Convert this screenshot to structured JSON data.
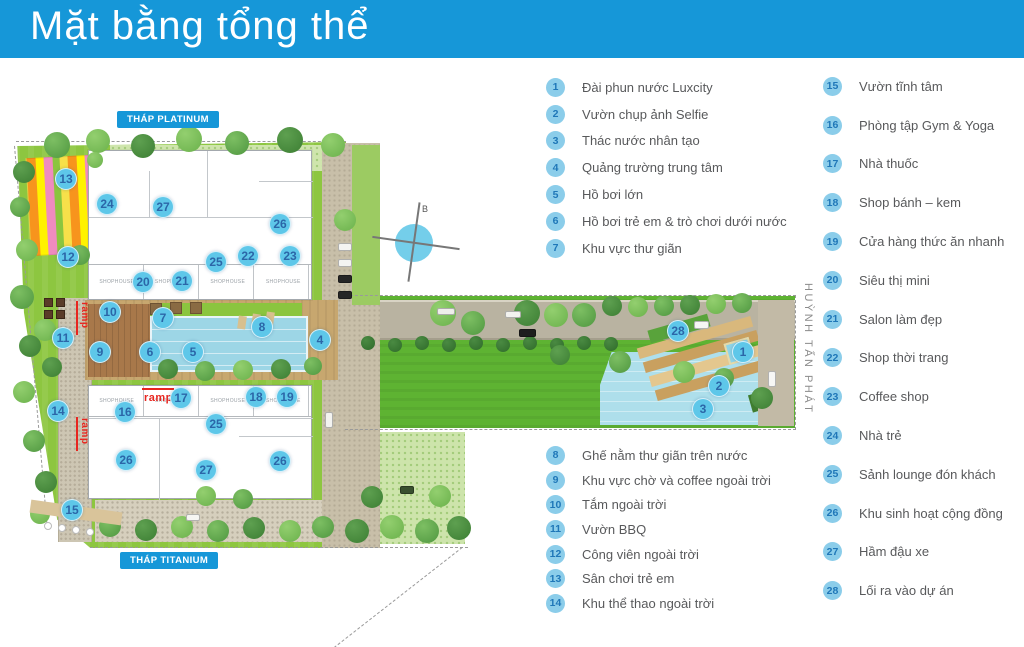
{
  "header": {
    "title": "Mặt bằng tổng thể",
    "bg_color": "#1697d8"
  },
  "map": {
    "tower_labels": [
      {
        "id": "platinum",
        "text": "THÁP PLATINUM"
      },
      {
        "id": "titanium",
        "text": "THÁP TITANIUM"
      }
    ],
    "street_label": "HUỲNH TẤN PHÁT",
    "compass_letter": "B",
    "ramp_label": "ramp",
    "room_label": "SHOPHOUSE",
    "marker_color": "#5ec7e9",
    "marker_number_color": "#2b66a8",
    "markers": [
      {
        "n": "1",
        "x": 743,
        "y": 352
      },
      {
        "n": "2",
        "x": 719,
        "y": 386
      },
      {
        "n": "3",
        "x": 703,
        "y": 409
      },
      {
        "n": "4",
        "x": 320,
        "y": 340
      },
      {
        "n": "5",
        "x": 193,
        "y": 352
      },
      {
        "n": "6",
        "x": 150,
        "y": 352
      },
      {
        "n": "7",
        "x": 163,
        "y": 318
      },
      {
        "n": "8",
        "x": 262,
        "y": 327
      },
      {
        "n": "9",
        "x": 100,
        "y": 352
      },
      {
        "n": "10",
        "x": 110,
        "y": 312
      },
      {
        "n": "11",
        "x": 63,
        "y": 338
      },
      {
        "n": "12",
        "x": 68,
        "y": 257
      },
      {
        "n": "13",
        "x": 66,
        "y": 179
      },
      {
        "n": "14",
        "x": 58,
        "y": 411
      },
      {
        "n": "15",
        "x": 72,
        "y": 510
      },
      {
        "n": "16",
        "x": 125,
        "y": 412
      },
      {
        "n": "17",
        "x": 181,
        "y": 398
      },
      {
        "n": "18",
        "x": 256,
        "y": 397
      },
      {
        "n": "19",
        "x": 287,
        "y": 397
      },
      {
        "n": "20",
        "x": 143,
        "y": 282
      },
      {
        "n": "21",
        "x": 182,
        "y": 281
      },
      {
        "n": "22",
        "x": 248,
        "y": 256
      },
      {
        "n": "23",
        "x": 290,
        "y": 256
      },
      {
        "n": "24",
        "x": 107,
        "y": 204
      },
      {
        "n": "25",
        "x": 216,
        "y": 262
      },
      {
        "n": "25",
        "x": 216,
        "y": 424
      },
      {
        "n": "26",
        "x": 280,
        "y": 224
      },
      {
        "n": "26",
        "x": 126,
        "y": 460
      },
      {
        "n": "26",
        "x": 280,
        "y": 461
      },
      {
        "n": "27",
        "x": 163,
        "y": 207
      },
      {
        "n": "27",
        "x": 206,
        "y": 470
      },
      {
        "n": "28",
        "x": 678,
        "y": 331
      }
    ]
  },
  "legend": {
    "circle_color": "#8bcdea",
    "number_color": "#1f77b8",
    "text_color": "#58595b",
    "columns": [
      {
        "position": "center-top",
        "items": [
          {
            "n": "1",
            "label": "Đài phun nước Luxcity"
          },
          {
            "n": "2",
            "label": "Vườn chụp ảnh Selfie"
          },
          {
            "n": "3",
            "label": "Thác nước nhân tạo"
          },
          {
            "n": "4",
            "label": "Quảng trường trung tâm"
          },
          {
            "n": "5",
            "label": "Hồ bơi lớn"
          },
          {
            "n": "6",
            "label": "Hồ bơi trẻ em & trò chơi dưới nước"
          },
          {
            "n": "7",
            "label": "Khu vực thư giãn"
          }
        ]
      },
      {
        "position": "center-bottom",
        "items": [
          {
            "n": "8",
            "label": "Ghế nằm thư giãn trên nước"
          },
          {
            "n": "9",
            "label": "Khu vực chờ và coffee ngoài trời"
          },
          {
            "n": "10",
            "label": "Tắm ngoài trời"
          },
          {
            "n": "11",
            "label": "Vườn BBQ"
          },
          {
            "n": "12",
            "label": "Công viên ngoài trời"
          },
          {
            "n": "13",
            "label": "Sân chơi trẻ em"
          },
          {
            "n": "14",
            "label": "Khu thể thao ngoài trời"
          }
        ]
      },
      {
        "position": "right",
        "items": [
          {
            "n": "15",
            "label": "Vườn tĩnh tâm"
          },
          {
            "n": "16",
            "label": "Phòng tập Gym & Yoga"
          },
          {
            "n": "17",
            "label": "Nhà thuốc"
          },
          {
            "n": "18",
            "label": "Shop bánh – kem"
          },
          {
            "n": "19",
            "label": "Cửa hàng thức ăn nhanh"
          },
          {
            "n": "20",
            "label": "Siêu thị mini"
          },
          {
            "n": "21",
            "label": "Salon làm đẹp"
          },
          {
            "n": "22",
            "label": "Shop thời trang"
          },
          {
            "n": "23",
            "label": "Coffee shop"
          },
          {
            "n": "24",
            "label": "Nhà trẻ"
          },
          {
            "n": "25",
            "label": "Sảnh lounge đón khách"
          },
          {
            "n": "26",
            "label": "Khu sinh hoạt cộng đồng"
          },
          {
            "n": "27",
            "label": "Hầm đậu xe"
          },
          {
            "n": "28",
            "label": "Lối ra vào dự án"
          }
        ]
      }
    ]
  }
}
